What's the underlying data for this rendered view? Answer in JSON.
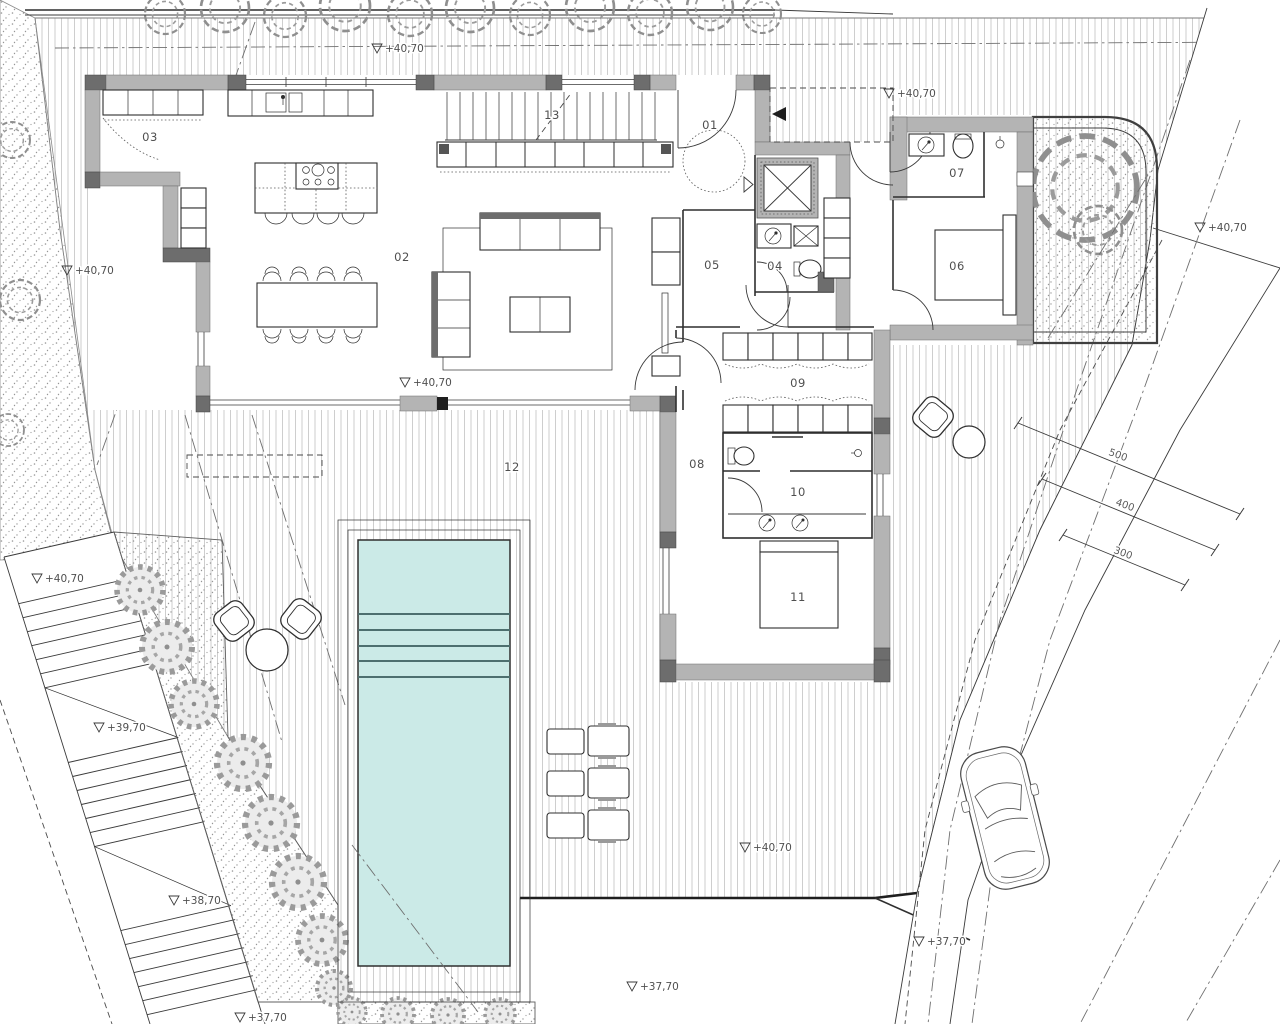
{
  "plan": {
    "kind": "architectural site / floor plan",
    "rooms": {
      "r01": "01",
      "r02": "02",
      "r03": "03",
      "r04": "04",
      "r05": "05",
      "r06": "06",
      "r07": "07",
      "r08": "08",
      "r09": "09",
      "r10": "10",
      "r11": "11",
      "r12": "12",
      "r13": "13"
    },
    "elevation_markers": {
      "m1": "+40,70",
      "m2": "+40,70",
      "m3": "+40,70",
      "m4": "+40,70",
      "m5": "+40,70",
      "m6": "+40,70",
      "m7": "+40,70",
      "m8": "+39,70",
      "m9": "+38,70",
      "m10": "+37,70",
      "m11": "+37,70",
      "m12": "+37,70"
    },
    "dimensions": {
      "d500": "500",
      "d400": "400",
      "d300": "300"
    },
    "colors": {
      "pool_water": "#cbeae7",
      "wall_fill": "#b4b4b4",
      "wall_dark": "#6d6d6d",
      "hatch_line": "#b9b9b9",
      "vegetation": "#9a9a9a",
      "line": "#2f2f2f",
      "label_text": "#4f4f4f",
      "paper": "#ffffff"
    }
  }
}
